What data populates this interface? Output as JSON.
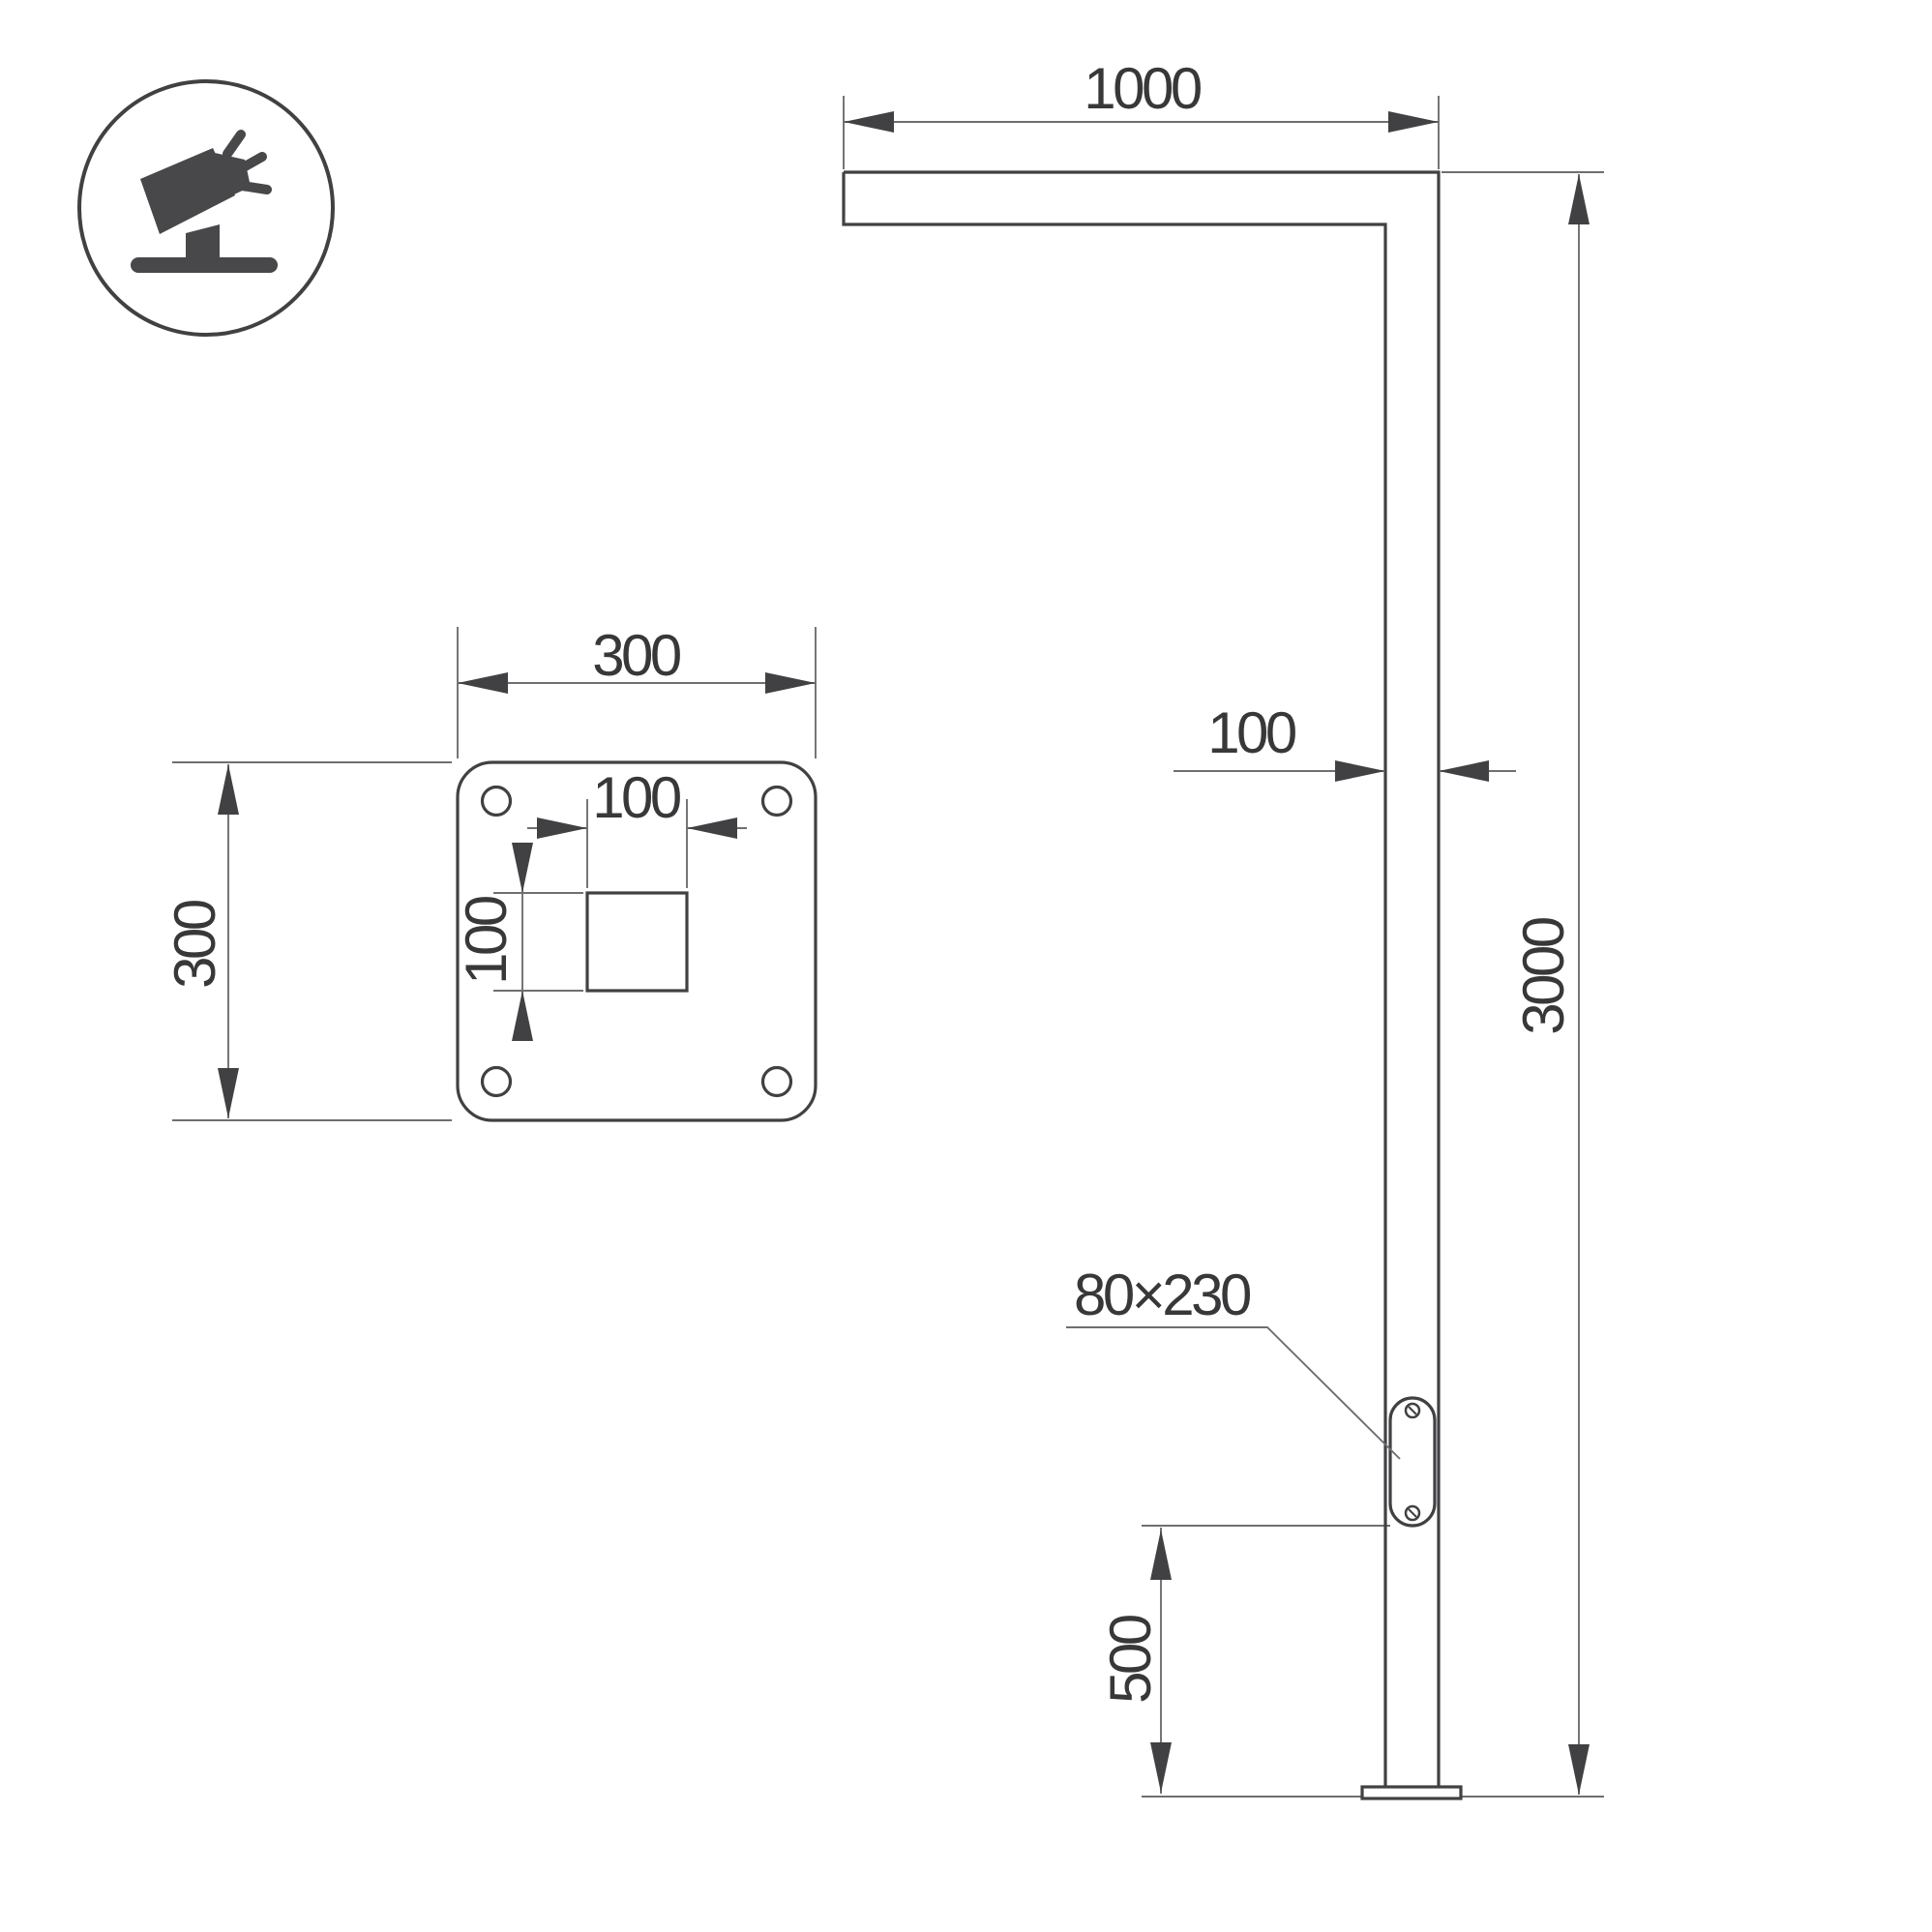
{
  "icon": {
    "name": "tilted-floodlight"
  },
  "side_view": {
    "arm_length": "1000",
    "pole_width": "100",
    "total_height": "3000",
    "service_door_size": "80×230",
    "door_height_from_base": "500"
  },
  "base_plate_view": {
    "plate_width": "300",
    "plate_height": "300",
    "cutout_width": "100",
    "cutout_height": "100"
  },
  "colors": {
    "object_line": "#414043",
    "dimension_line": "#6e6f72",
    "text": "#38383a",
    "icon_fill": "#48484b",
    "background": "#ffffff"
  }
}
